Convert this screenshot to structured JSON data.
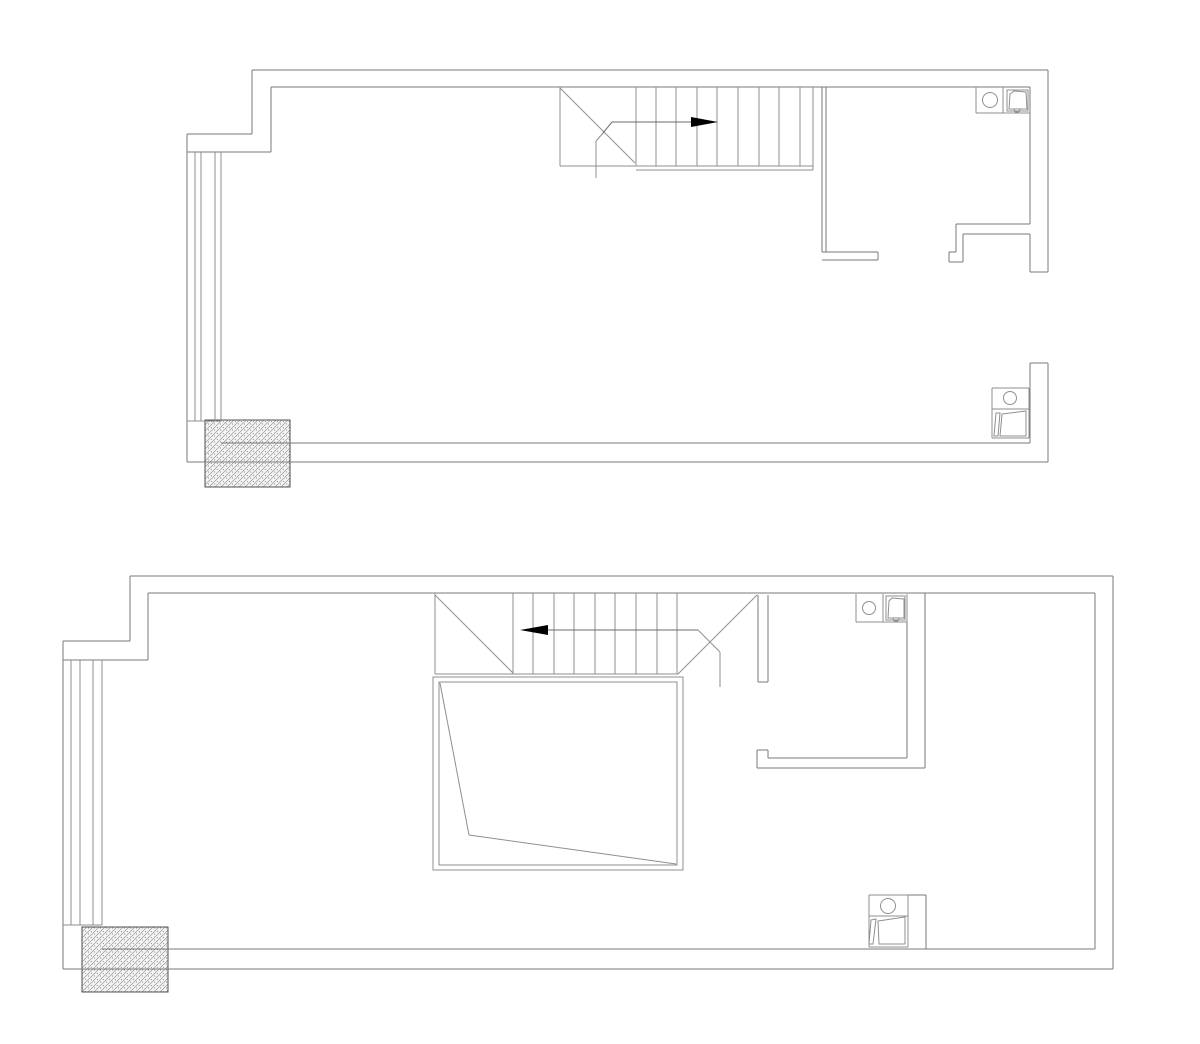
{
  "canvas": {
    "width": 1200,
    "height": 1044,
    "background": "#ffffff"
  },
  "colors": {
    "wall_line": "#7a7a7a",
    "detail_line": "#8f8f8f",
    "fixture_line": "#8f8f8f",
    "arrow_line": "#6b6b6b",
    "arrow_fill": "#000000",
    "hatch_bg": "#f4f4f4",
    "hatch_line": "#9a9a9a",
    "hatch_dot": "#5a5a5a",
    "hatch_border": "#4f4f4f"
  },
  "plans": [
    {
      "name": "upper-floor-plan",
      "layers": [
        {
          "name": "structural-column",
          "kind": "hatch",
          "hatch": [
            [
              205,
              420,
              85,
              67
            ]
          ]
        },
        {
          "name": "exterior-walls",
          "stroke": "wall_line",
          "lines": [
            [
              252,
              70,
              1048,
              70
            ],
            [
              252,
              70,
              252,
              134
            ],
            [
              187,
              134,
              252,
              134
            ],
            [
              187,
              134,
              187,
              462
            ],
            [
              187,
              462,
              1048,
              462
            ],
            [
              1048,
              70,
              1048,
              272
            ],
            [
              1030,
              272,
              1048,
              272
            ],
            [
              1030,
              363,
              1048,
              363
            ],
            [
              1048,
              363,
              1048,
              462
            ],
            [
              271,
              87,
              1030,
              87
            ],
            [
              271,
              87,
              271,
              152
            ],
            [
              187,
              152,
              271,
              152
            ],
            [
              1030,
              87,
              1030,
              224
            ],
            [
              1030,
              234,
              1030,
              272
            ],
            [
              1030,
              363,
              1030,
              443
            ],
            [
              221,
              443,
              1030,
              443
            ]
          ]
        },
        {
          "name": "interior-walls",
          "stroke": "wall_line",
          "lines": [
            [
              822,
              87,
              822,
              252
            ],
            [
              826,
              87,
              826,
              252
            ],
            [
              822,
              252,
              878,
              252
            ],
            [
              822,
              260,
              878,
              260
            ],
            [
              878,
              252,
              878,
              260
            ],
            [
              956,
              224,
              1030,
              224
            ],
            [
              963,
              234,
              1030,
              234
            ],
            [
              956,
              224,
              956,
              252
            ],
            [
              949,
              252,
              956,
              252
            ],
            [
              949,
              252,
              949,
              262
            ],
            [
              949,
              262,
              963,
              262
            ],
            [
              963,
              234,
              963,
              262
            ]
          ]
        },
        {
          "name": "left-window",
          "stroke": "detail_line",
          "lines": [
            [
              195,
              152,
              195,
              421
            ],
            [
              201,
              152,
              201,
              421
            ],
            [
              215,
              152,
              215,
              421
            ],
            [
              221,
              152,
              221,
              421
            ],
            [
              187,
              421,
              221,
              421
            ]
          ]
        },
        {
          "name": "staircase",
          "stroke": "detail_line",
          "lines": [
            [
              560,
              87,
              560,
              166
            ],
            [
              560,
              166,
              813,
              166
            ],
            [
              813,
              87,
              813,
              170
            ],
            [
              636,
              170,
              813,
              170
            ],
            [
              560,
              88,
              635,
              163
            ],
            [
              604,
              132,
              596,
              141
            ],
            [
              596,
              141,
              596,
              178
            ],
            [
              636,
              87,
              636,
              166
            ],
            [
              656,
              87,
              656,
              166
            ],
            [
              676,
              87,
              676,
              166
            ],
            [
              697,
              87,
              697,
              166
            ],
            [
              717,
              87,
              717,
              166
            ],
            [
              738,
              87,
              738,
              166
            ],
            [
              759,
              87,
              759,
              166
            ],
            [
              779,
              87,
              779,
              166
            ],
            [
              800,
              87,
              800,
              166
            ]
          ]
        },
        {
          "name": "stair-direction-arrow",
          "stroke": "arrow_line",
          "lines": [
            [
              603,
              133,
              612,
              122
            ],
            [
              612,
              122,
              691,
              122
            ]
          ],
          "solids": [
            [
              [
                718,
                122
              ],
              [
                691,
                117
              ],
              [
                691,
                127
              ]
            ]
          ]
        },
        {
          "name": "sink-unit",
          "stroke": "fixture_line",
          "lines": [
            [
              976,
              87,
              976,
              113
            ],
            [
              976,
              113,
              1030,
              113
            ],
            [
              1003,
              87,
              1003,
              113
            ],
            [
              1014,
              109,
              1015,
              112
            ],
            [
              1015,
              112,
              1019,
              112
            ],
            [
              1019,
              112,
              1020,
              109
            ]
          ],
          "outlines": [
            [
              [
                1007,
                90
              ],
              [
                1028,
                90
              ],
              [
                1028,
                111
              ],
              [
                1007,
                111
              ]
            ],
            [
              [
                1009,
                109
              ],
              [
                1010,
                94
              ],
              [
                1014,
                91
              ],
              [
                1026,
                92
              ],
              [
                1027,
                109
              ]
            ]
          ],
          "circles": [
            [
              990,
              100,
              7.5
            ]
          ]
        },
        {
          "name": "toilet",
          "stroke": "fixture_line",
          "lines": [
            [
              992,
              388,
              992,
              438
            ],
            [
              992,
              388,
              1029,
              388
            ],
            [
              992,
              438,
              1029,
              438
            ],
            [
              1029,
              388,
              1029,
              438
            ],
            [
              992,
              409,
              1029,
              409
            ]
          ],
          "outlines": [
            [
              [
                996,
                413
              ],
              [
                1000,
                413
              ],
              [
                998,
                436
              ],
              [
                994,
                436
              ]
            ],
            [
              [
                1002,
                414
              ],
              [
                1026,
                411
              ],
              [
                1026,
                436
              ],
              [
                1000,
                436
              ]
            ]
          ],
          "circles": [
            [
              1010,
              398,
              6.5
            ]
          ]
        }
      ]
    },
    {
      "name": "lower-floor-plan",
      "layers": [
        {
          "name": "structural-column",
          "kind": "hatch",
          "hatch": [
            [
              82,
              927,
              86,
              65
            ]
          ]
        },
        {
          "name": "exterior-walls",
          "stroke": "wall_line",
          "lines": [
            [
              130,
              576,
              1113,
              576
            ],
            [
              130,
              576,
              130,
              641
            ],
            [
              63,
              641,
              130,
              641
            ],
            [
              63,
              641,
              63,
              969
            ],
            [
              63,
              969,
              1113,
              969
            ],
            [
              1113,
              576,
              1113,
              969
            ],
            [
              148,
              593,
              1095,
              593
            ],
            [
              148,
              593,
              148,
              660
            ],
            [
              63,
              660,
              148,
              660
            ],
            [
              1095,
              593,
              1095,
              949
            ],
            [
              102,
              949,
              1095,
              949
            ]
          ]
        },
        {
          "name": "interior-walls",
          "stroke": "wall_line",
          "lines": [
            [
              907,
              622,
              907,
              758
            ],
            [
              925,
              593,
              925,
              768
            ],
            [
              768,
              758,
              907,
              758
            ],
            [
              757,
              768,
              925,
              768
            ],
            [
              757,
              750,
              757,
              768
            ],
            [
              757,
              750,
              768,
              750
            ],
            [
              768,
              750,
              768,
              758
            ],
            [
              758,
              595,
              758,
              682
            ],
            [
              768,
              595,
              768,
              682
            ],
            [
              758,
              682,
              768,
              682
            ],
            [
              908,
              895,
              926,
              895
            ],
            [
              926,
              895,
              926,
              949
            ]
          ]
        },
        {
          "name": "left-window",
          "stroke": "detail_line",
          "lines": [
            [
              71,
              660,
              71,
              925
            ],
            [
              80,
              660,
              80,
              925
            ],
            [
              93,
              660,
              93,
              925
            ],
            [
              102,
              660,
              102,
              925
            ],
            [
              63,
              925,
              102,
              925
            ]
          ]
        },
        {
          "name": "staircase",
          "stroke": "detail_line",
          "lines": [
            [
              435,
              593,
              435,
              674
            ],
            [
              435,
              674,
              678,
              674
            ],
            [
              435,
              595,
              513,
              673
            ],
            [
              678,
              674,
              757,
              595
            ],
            [
              698,
              630,
              720,
              652
            ],
            [
              720,
              652,
              720,
              687
            ],
            [
              513,
              593,
              513,
              674
            ],
            [
              533,
              593,
              533,
              674
            ],
            [
              554,
              593,
              554,
              674
            ],
            [
              574,
              593,
              574,
              674
            ],
            [
              595,
              593,
              595,
              674
            ],
            [
              615,
              593,
              615,
              674
            ],
            [
              636,
              593,
              636,
              674
            ],
            [
              657,
              593,
              657,
              674
            ],
            [
              677,
              593,
              677,
              674
            ]
          ]
        },
        {
          "name": "stair-direction-arrow",
          "stroke": "arrow_line",
          "lines": [
            [
              548,
              630,
              698,
              630
            ]
          ],
          "solids": [
            [
              [
                520,
                630
              ],
              [
                548,
                625
              ],
              [
                548,
                635
              ]
            ]
          ]
        },
        {
          "name": "floor-void-opening",
          "stroke": "detail_line",
          "lines": [
            [
              440,
              683,
              469,
              835
            ],
            [
              469,
              835,
              676,
              864
            ]
          ],
          "outlines": [
            [
              [
                433,
                677
              ],
              [
                683,
                677
              ],
              [
                683,
                870
              ],
              [
                433,
                870
              ]
            ],
            [
              [
                439,
                682
              ],
              [
                677,
                682
              ],
              [
                677,
                865
              ],
              [
                439,
                865
              ]
            ]
          ]
        },
        {
          "name": "sink-unit",
          "stroke": "fixture_line",
          "lines": [
            [
              856,
              594,
              856,
              622
            ],
            [
              856,
              622,
              907,
              622
            ],
            [
              883,
              594,
              883,
              622
            ],
            [
              907,
              594,
              907,
              622
            ],
            [
              893,
              618,
              894,
              621
            ],
            [
              894,
              621,
              898,
              621
            ],
            [
              898,
              621,
              899,
              618
            ]
          ],
          "outlines": [
            [
              [
                886,
                596
              ],
              [
                905,
                596
              ],
              [
                905,
                620
              ],
              [
                886,
                620
              ]
            ],
            [
              [
                888,
                618
              ],
              [
                889,
                601
              ],
              [
                892,
                598
              ],
              [
                904,
                599
              ],
              [
                904,
                618
              ]
            ]
          ],
          "circles": [
            [
              869,
              608,
              6.5
            ]
          ]
        },
        {
          "name": "toilet",
          "stroke": "fixture_line",
          "lines": [
            [
              869,
              895,
              869,
              947
            ],
            [
              869,
              895,
              908,
              895
            ],
            [
              869,
              947,
              908,
              947
            ],
            [
              908,
              895,
              908,
              947
            ],
            [
              869,
              916,
              908,
              916
            ]
          ],
          "outlines": [
            [
              [
                871,
                920
              ],
              [
                876,
                919
              ],
              [
                873,
                944
              ],
              [
                869,
                944
              ]
            ],
            [
              [
                878,
                921
              ],
              [
                905,
                917
              ],
              [
                905,
                944
              ],
              [
                879,
                944
              ]
            ]
          ],
          "circles": [
            [
              888,
              906,
              7.5
            ]
          ]
        }
      ]
    }
  ]
}
